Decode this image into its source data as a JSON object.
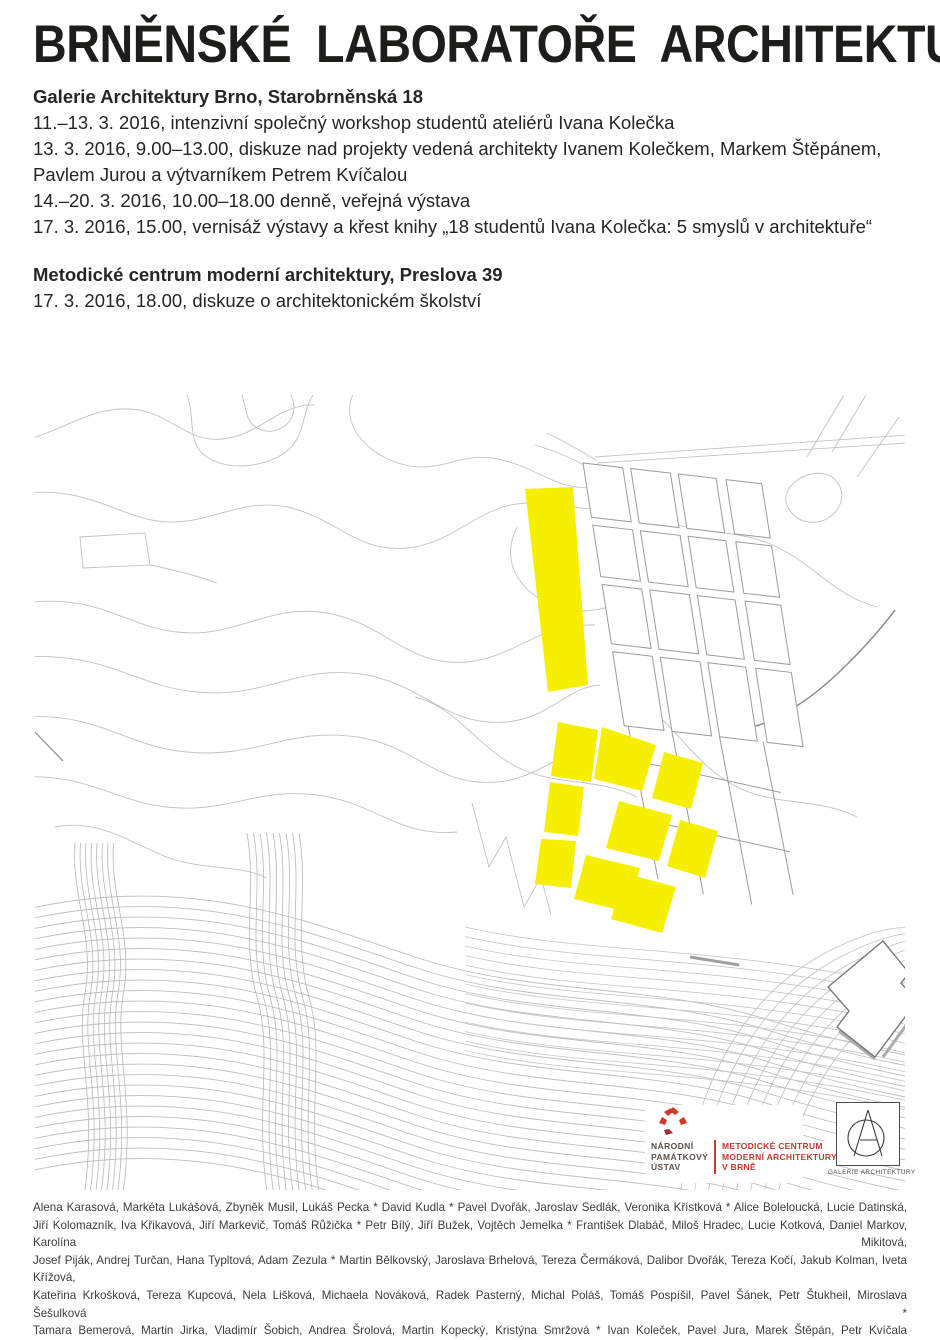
{
  "poster": {
    "title": "BRNĚNSKÉ LABORATOŘE ARCHITEKTURY",
    "sections": [
      {
        "heading": "Galerie Architektury Brno, Starobrněnská 18",
        "lines": [
          "11.–13. 3. 2016, intenzivní společný workshop studentů ateliérů Ivana Kolečka",
          "13. 3. 2016, 9.00–13.00, diskuze nad projekty vedená architekty Ivanem Kolečkem, Markem Štěpánem,",
          "Pavlem Jurou a výtvarníkem Petrem Kvíčalou",
          "14.–20. 3. 2016, 10.00–18.00 denně, veřejná výstava",
          "17. 3. 2016, 15.00, vernisáž výstavy a křest knihy „18 studentů Ivana Kolečka: 5 smyslů v architektuře“"
        ]
      },
      {
        "heading": "Metodické centrum moderní architektury, Preslova 39",
        "lines": [
          "17. 3. 2016, 18.00, diskuze o architektonickém školství"
        ]
      }
    ]
  },
  "logos": {
    "npu": {
      "line1": "NÁRODNÍ",
      "line2": "PAMÁTKOVÝ",
      "line3": "ÚSTAV"
    },
    "mcma": {
      "line1": "METODICKÉ CENTRUM",
      "line2": "MODERNÍ ARCHITEKTURY",
      "line3": "V BRNĚ"
    },
    "ga": {
      "label": "GALERIE ARCHITEKTURY"
    }
  },
  "footer": {
    "lines": [
      "Alena Karasová, Markéta Lukášová, Zbyněk Musil, Lukáš Pecka * David Kudla * Pavel Dvořák, Jaroslav Sedlák, Veronika Křístková * Alice Boleloucká, Lucie Datinská,",
      "Jiří Kolomazník, Iva Křikavová, Jiří Markevič, Tomáš Růžička * Petr Bílý, Jiří Bužek, Vojtěch Jemelka * František Dlabáč, Miloš Hradec, Lucie Kotková, Daniel Markov, Karolína Mikitová,",
      "Josef Piják, Andrej Turčan, Hana Typltová, Adam Zezula * Martin Bělkovský, Jaroslava Brhelová, Tereza Čermáková, Dalibor Dvořák, Tereza Kočí, Jakub Kolman, Iveta Křížová,",
      "Kateřina Krkošková, Tereza Kupcová, Nela Lišková, Michaela Nováková, Radek Pasterný, Michal Poláš, Tomáš Pospíšil, Pavel Šánek, Petr Štukheil, Miroslava Šešulková *",
      "Tamara Bemerová, Martin Jirka, Vladimír Šobich, Andrea Šrolová, Martin Kopecký, Kristýna Smržová * Ivan Koleček, Pavel Jura, Marek Štěpán, Petr Kvíčala"
    ]
  },
  "colors": {
    "yellow": "#f7ef00",
    "contour": "#c3c3c3",
    "accent_red": "#c23b2e",
    "dark_red": "#9c2f26",
    "npu_text": "#5d4f4a",
    "title_text": "#1d1d1b"
  },
  "map": {
    "bundles": [
      {
        "d": "M-40,522 C140,472 260,522 380,562 C500,602 620,587 740,627 C830,654 880,662 915,668",
        "n": 26,
        "dx": 0,
        "dy": 10.5,
        "c": "#bfbfbf",
        "w": 0.9
      },
      {
        "d": "M430,532 C560,562 700,547 915,602",
        "n": 14,
        "dx": 0,
        "dy": 9.5,
        "c": "#c6c6c6",
        "w": 0.8
      },
      {
        "d": "M40,448 C36,502 60,542 50,598 C40,655 62,702 50,795",
        "n": 8,
        "dx": 5.5,
        "dy": 0,
        "c": "#b8b8b8",
        "w": 0.8
      },
      {
        "d": "M212,438 C222,496 206,546 222,602 C238,658 220,712 232,798",
        "n": 9,
        "dx": 6.5,
        "dy": 0,
        "c": "#b8b8b8",
        "w": 0.8
      },
      {
        "d": "M645,800 C662,692 706,602 792,557 C834,536 858,531 880,533",
        "n": 8,
        "dx": 13,
        "dy": 5,
        "c": "#c0c0c0",
        "w": 0.8
      }
    ],
    "grid": {
      "origin": [
        548,
        68
      ],
      "u": [
        0.993,
        0.115
      ],
      "v": [
        0.155,
        0.988
      ],
      "cols": [
        [
          0,
          40
        ],
        [
          48,
          40
        ],
        [
          96,
          38
        ],
        [
          144,
          36
        ]
      ],
      "rows": [
        [
          0,
          55
        ],
        [
          63,
          52
        ],
        [
          123,
          60
        ],
        [
          191,
          75
        ]
      ],
      "streets": [
        [
          [
            4,
            266
          ],
          [
            10,
            420
          ]
        ],
        [
          [
            48,
            266
          ],
          [
            54,
            430
          ]
        ],
        [
          [
            96,
            266
          ],
          [
            102,
            435
          ]
        ],
        [
          [
            140,
            266
          ],
          [
            146,
            420
          ]
        ],
        [
          [
            0,
            300
          ],
          [
            150,
            316
          ]
        ],
        [
          [
            0,
            360
          ],
          [
            150,
            376
          ]
        ]
      ],
      "fill": "#ffffff",
      "stroke": "#9c9c9c"
    },
    "highlights": {
      "slab": [
        [
          490,
          94
        ],
        [
          538,
          92
        ],
        [
          553,
          290
        ],
        [
          513,
          297
        ]
      ],
      "cluster": [
        [
          [
            523,
            327
          ],
          [
            563,
            335
          ],
          [
            556,
            387
          ],
          [
            516,
            381
          ]
        ],
        [
          [
            515,
            387
          ],
          [
            549,
            392
          ],
          [
            543,
            441
          ],
          [
            509,
            437
          ]
        ],
        [
          [
            506,
            444
          ],
          [
            541,
            446
          ],
          [
            536,
            493
          ],
          [
            500,
            489
          ]
        ],
        [
          [
            567,
            332
          ],
          [
            621,
            350
          ],
          [
            607,
            396
          ],
          [
            559,
            384
          ]
        ],
        [
          [
            629,
            357
          ],
          [
            668,
            368
          ],
          [
            656,
            414
          ],
          [
            617,
            403
          ]
        ],
        [
          [
            584,
            406
          ],
          [
            637,
            420
          ],
          [
            624,
            466
          ],
          [
            571,
            453
          ]
        ],
        [
          [
            645,
            425
          ],
          [
            683,
            436
          ],
          [
            670,
            483
          ],
          [
            632,
            471
          ]
        ],
        [
          [
            551,
            460
          ],
          [
            605,
            473
          ],
          [
            592,
            517
          ],
          [
            539,
            504
          ]
        ],
        [
          [
            589,
            478
          ],
          [
            641,
            492
          ],
          [
            627,
            538
          ],
          [
            576,
            524
          ]
        ]
      ]
    }
  }
}
